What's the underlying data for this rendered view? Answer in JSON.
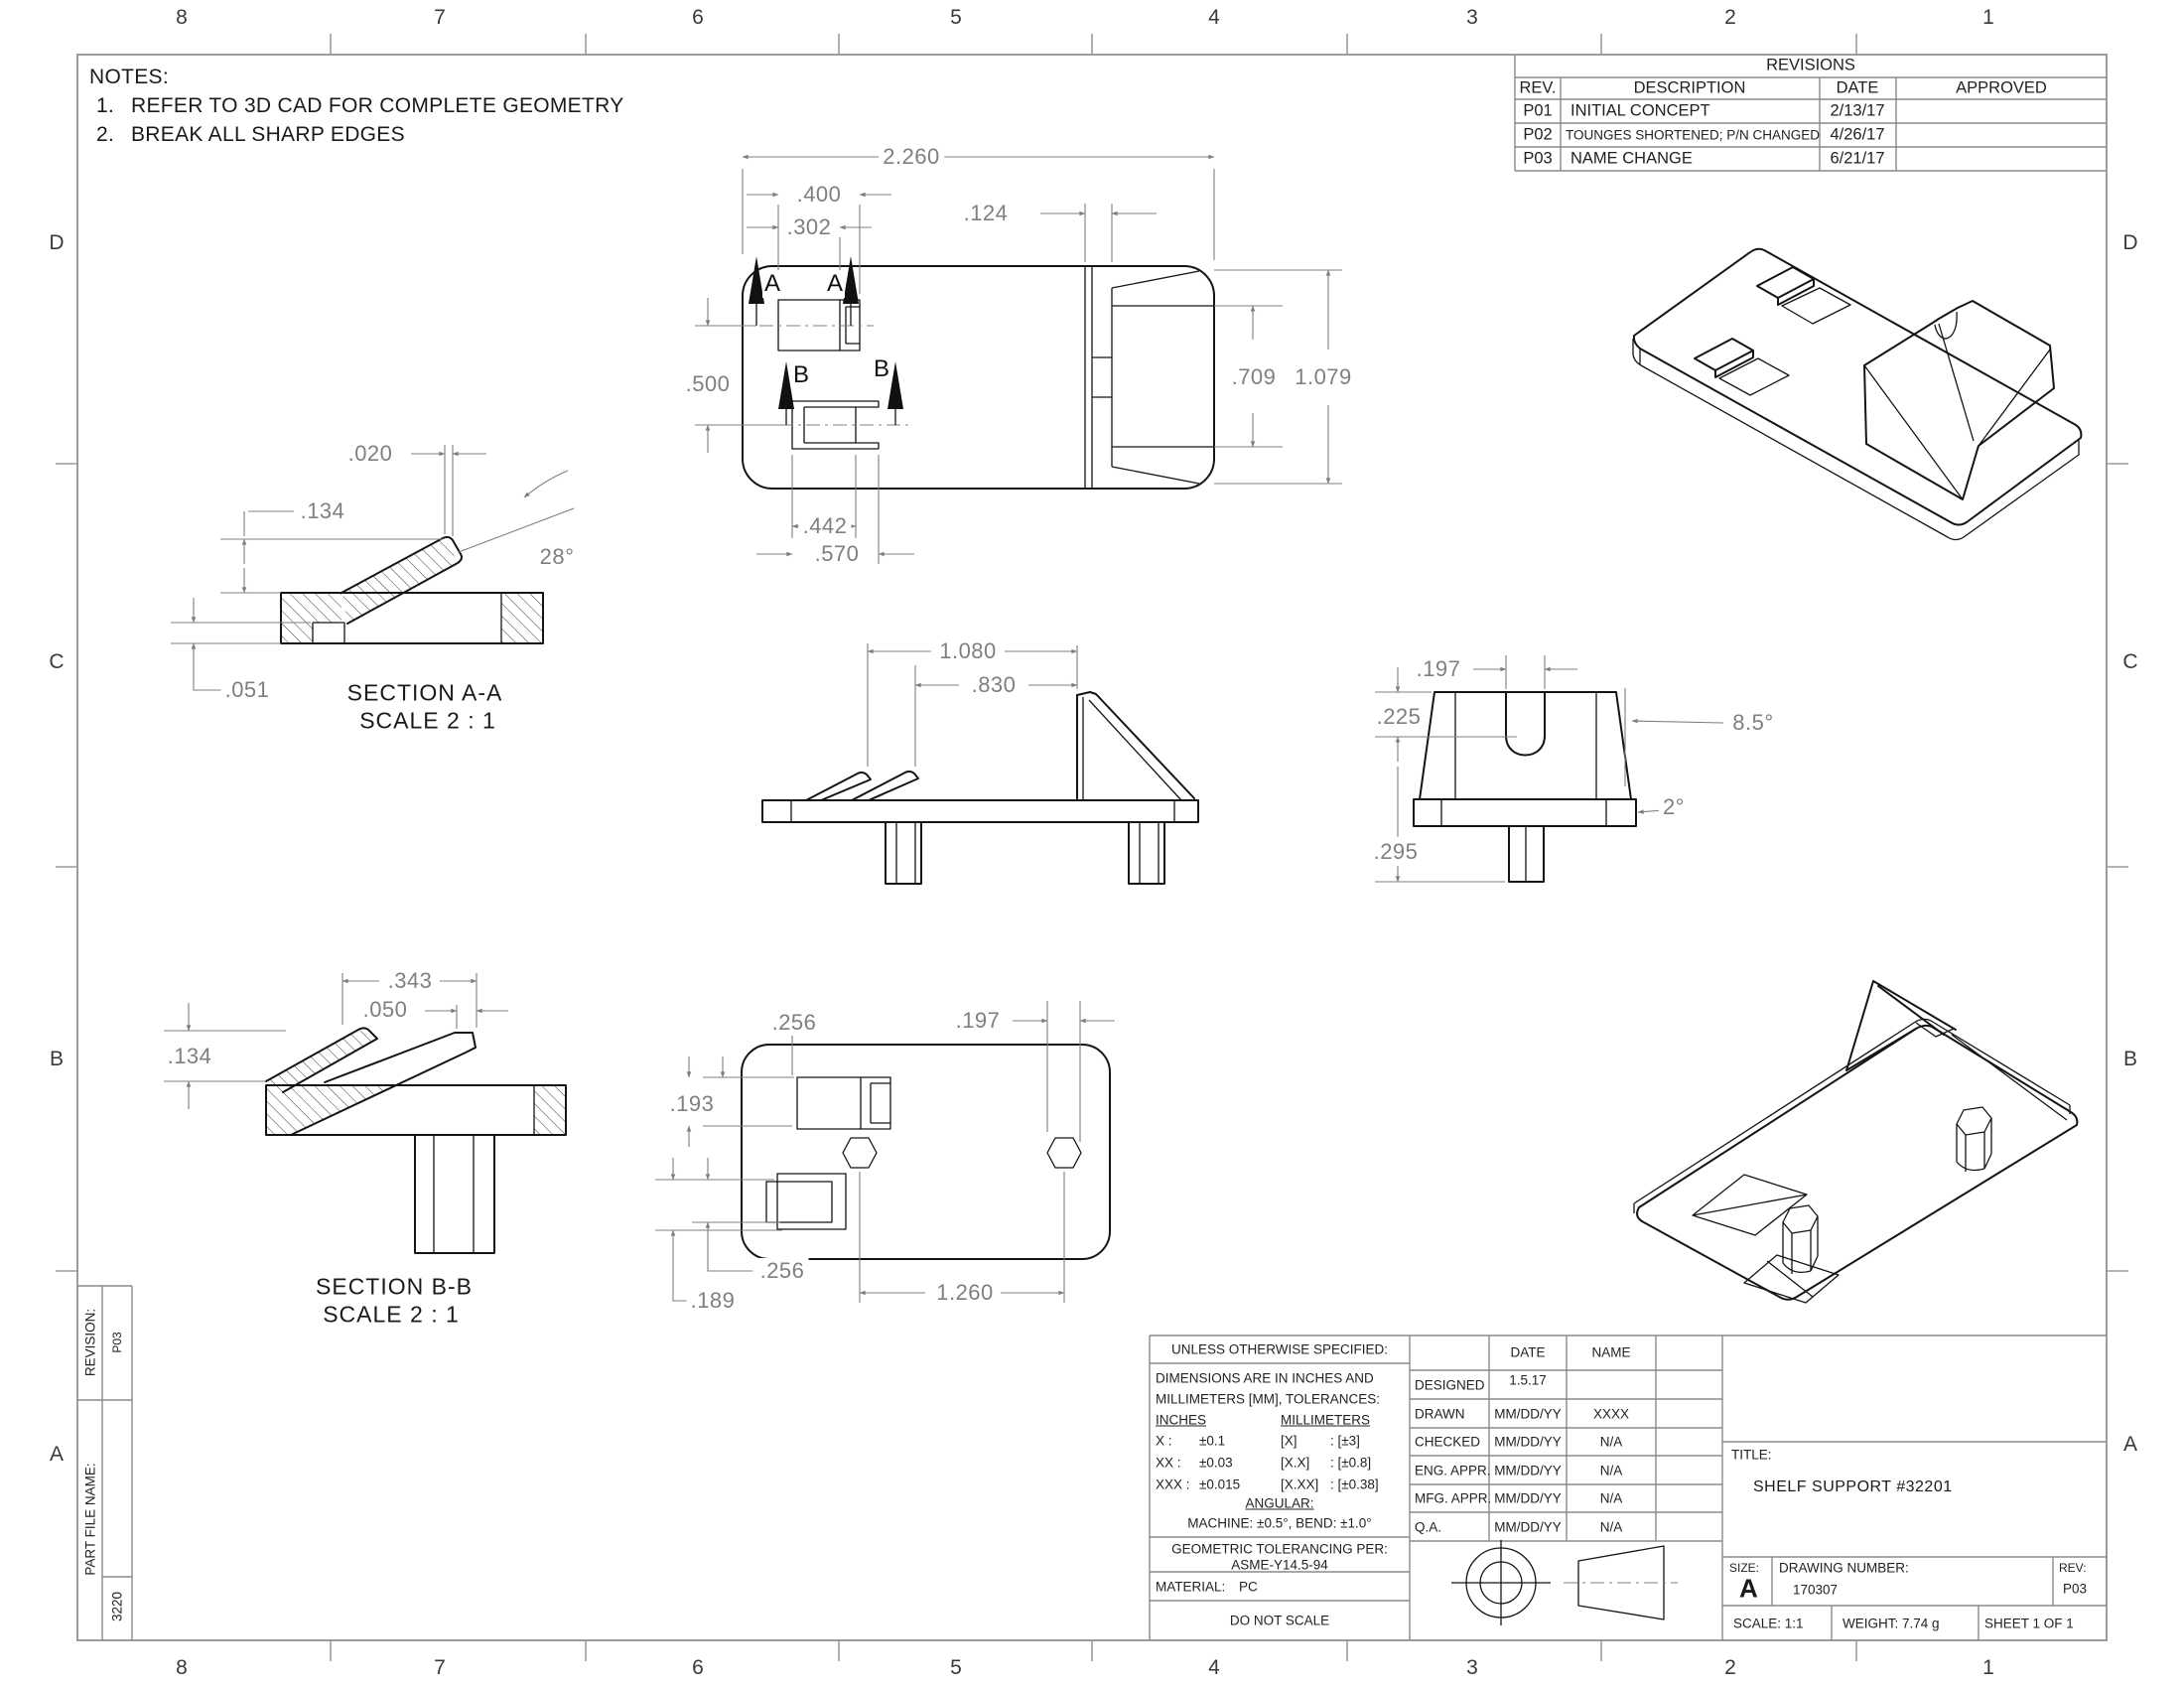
{
  "sheet": {
    "zones_top": [
      "8",
      "7",
      "6",
      "5",
      "4",
      "3",
      "2",
      "1"
    ],
    "zones_bottom": [
      "8",
      "7",
      "6",
      "5",
      "4",
      "3",
      "2",
      "1"
    ],
    "zones_left": [
      "D",
      "C",
      "B",
      "A"
    ],
    "zones_right": [
      "D",
      "C",
      "B",
      "A"
    ]
  },
  "notes": {
    "title": "NOTES:",
    "items": [
      {
        "n": "1.",
        "t": "REFER TO 3D CAD FOR COMPLETE GEOMETRY"
      },
      {
        "n": "2.",
        "t": "BREAK ALL SHARP EDGES"
      }
    ]
  },
  "revisions": {
    "title": "REVISIONS",
    "headers": [
      "REV.",
      "DESCRIPTION",
      "DATE",
      "APPROVED"
    ],
    "rows": [
      [
        "P01",
        "INITIAL CONCEPT",
        "2/13/17",
        ""
      ],
      [
        "P02",
        "TOUNGES SHORTENED; P/N CHANGED",
        "4/26/17",
        ""
      ],
      [
        "P03",
        "NAME CHANGE",
        "6/21/17",
        ""
      ]
    ]
  },
  "dims": {
    "top": {
      "overall_w": "2.260",
      "slot_a_w": ".400",
      "slot_a_t": ".302",
      "lip": ".124",
      "slot_gap": ".500",
      "pocket_h": ".709",
      "overall_h": "1.079",
      "slot_b_t": ".442",
      "slot_b_w": ".570"
    },
    "marks": {
      "a": "A",
      "b": "B"
    },
    "section_aa": {
      "name": "SECTION A-A",
      "scale": "SCALE 2 : 1",
      "tip": ".020",
      "height": ".134",
      "step": ".051",
      "angle": "28°"
    },
    "front": {
      "wedge": "1.080",
      "tongue": ".830"
    },
    "side": {
      "slot_w": ".197",
      "slot_d": ".225",
      "leg": ".295",
      "draft": "8.5°",
      "base": "2°"
    },
    "section_bb": {
      "name": "SECTION B-B",
      "scale": "SCALE 2 : 1",
      "span": ".343",
      "notch": ".050",
      "height": ".134"
    },
    "bottom": {
      "slot_off": ".256",
      "peg_w": ".197",
      "slot_h": ".193",
      "slot_d_off": ".256",
      "edge": ".189",
      "peg_pitch": "1.260"
    }
  },
  "side_blocks": {
    "revision_label": "REVISION:",
    "revision_value": "P03",
    "part_file_label": "PART FILE NAME:",
    "part_file_value": "3220"
  },
  "title_block": {
    "unless": "UNLESS OTHERWISE SPECIFIED:",
    "dims_line1": "DIMENSIONS ARE IN INCHES AND",
    "dims_line2": "MILLIMETERS [MM], TOLERANCES:",
    "inches_header": "INCHES",
    "mm_header": "MILLIMETERS",
    "tol_rows": [
      [
        "X :",
        "±0.1",
        "[X]",
        ": [±3]"
      ],
      [
        "XX :",
        "±0.03",
        "[X.X]",
        ": [±0.8]"
      ],
      [
        "XXX :",
        "±0.015",
        "[X.XX]",
        ": [±0.38]"
      ]
    ],
    "angular_header": "ANGULAR:",
    "angular_value": "MACHINE: ±0.5°, BEND: ±1.0°",
    "geo_line1": "GEOMETRIC TOLERANCING PER:",
    "geo_line2": "ASME-Y14.5-94",
    "material_label": "MATERIAL:",
    "material_value": "PC",
    "do_not_scale": "DO NOT SCALE",
    "signoff": {
      "col_date": "DATE",
      "col_name": "NAME",
      "rows": [
        [
          "DESIGNED",
          "1.5.17",
          ""
        ],
        [
          "DRAWN",
          "MM/DD/YY",
          "XXXX"
        ],
        [
          "CHECKED",
          "MM/DD/YY",
          "N/A"
        ],
        [
          "ENG. APPR.",
          "MM/DD/YY",
          "N/A"
        ],
        [
          "MFG. APPR.",
          "MM/DD/YY",
          "N/A"
        ],
        [
          "Q.A.",
          "MM/DD/YY",
          "N/A"
        ]
      ]
    },
    "title_label": "TITLE:",
    "title_value": "SHELF SUPPORT #32201",
    "size_label": "SIZE:",
    "size_value": "A",
    "dwg_label": "DRAWING NUMBER:",
    "dwg_value": "170307",
    "rev_label": "REV:",
    "rev_value": "P03",
    "scale_text": "SCALE: 1:1",
    "weight_text": "WEIGHT: 7.74 g",
    "sheet_text": "SHEET 1 OF 1"
  }
}
